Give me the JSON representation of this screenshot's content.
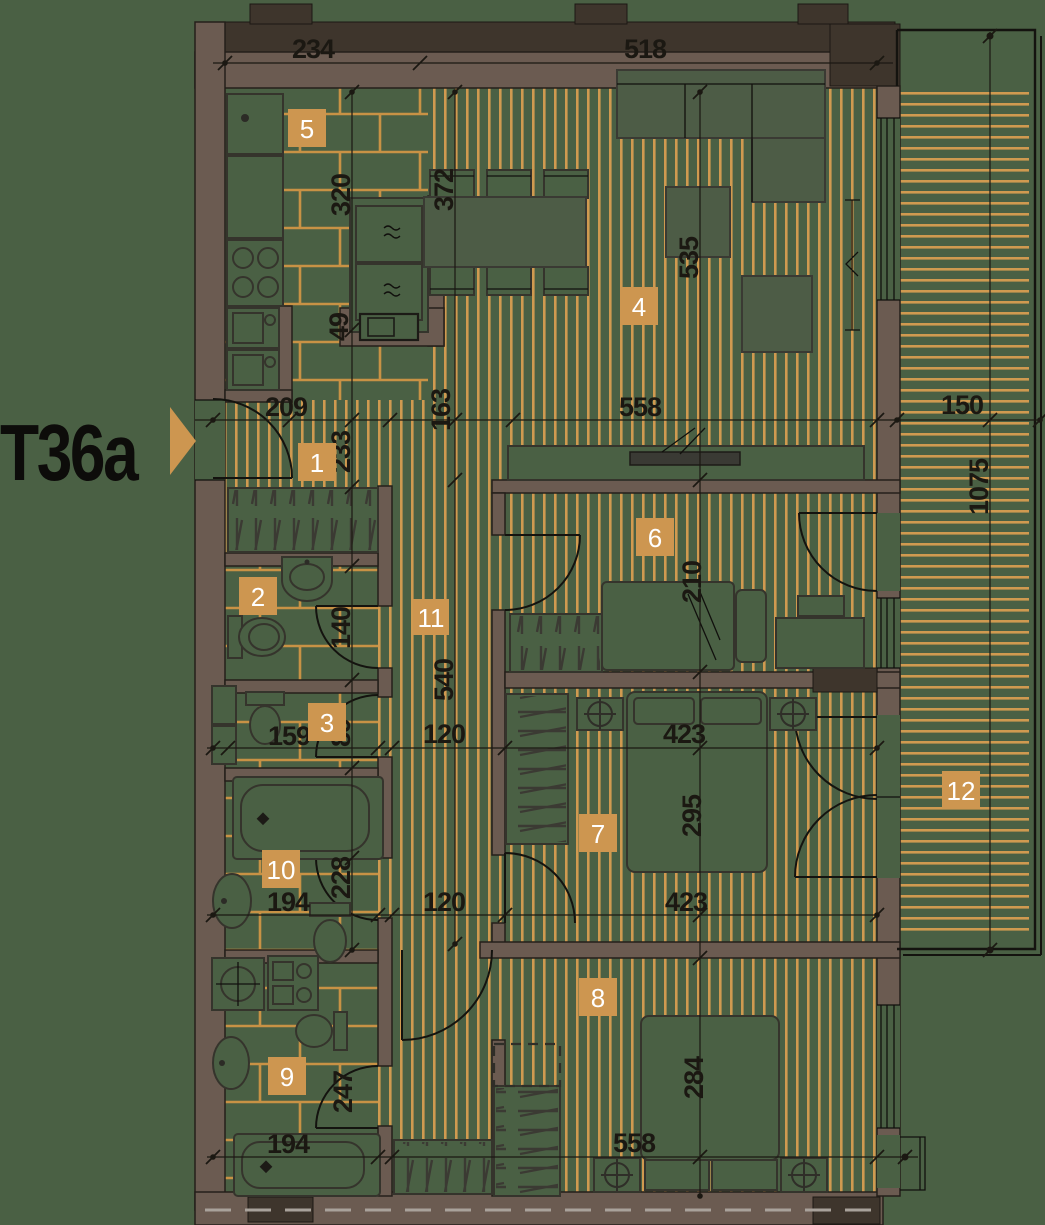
{
  "title": {
    "label": "T36a"
  },
  "rooms": [
    {
      "number": "1"
    },
    {
      "number": "2"
    },
    {
      "number": "3"
    },
    {
      "number": "4"
    },
    {
      "number": "5"
    },
    {
      "number": "6"
    },
    {
      "number": "7"
    },
    {
      "number": "8"
    },
    {
      "number": "9"
    },
    {
      "number": "10"
    },
    {
      "number": "11"
    },
    {
      "number": "12"
    }
  ],
  "dimensions": [
    {
      "value": "234"
    },
    {
      "value": "518"
    },
    {
      "value": "320"
    },
    {
      "value": "372"
    },
    {
      "value": "535"
    },
    {
      "value": "49"
    },
    {
      "value": "209"
    },
    {
      "value": "163"
    },
    {
      "value": "558"
    },
    {
      "value": "150"
    },
    {
      "value": "233"
    },
    {
      "value": "1075"
    },
    {
      "value": "140"
    },
    {
      "value": "540"
    },
    {
      "value": "210"
    },
    {
      "value": "159"
    },
    {
      "value": "89"
    },
    {
      "value": "120"
    },
    {
      "value": "423"
    },
    {
      "value": "295"
    },
    {
      "value": "228"
    },
    {
      "value": "194"
    },
    {
      "value": "120"
    },
    {
      "value": "423"
    },
    {
      "value": "247"
    },
    {
      "value": "284"
    },
    {
      "value": "194"
    },
    {
      "value": "558"
    }
  ],
  "colors": {
    "background": "#4a6044",
    "floor_stripe": "#d09a50",
    "tile_line": "#c89245",
    "badge": "#cd9650",
    "wall": "#6b5b51",
    "wall_dark": "#3e352c",
    "line": "#1b1812",
    "badge_text": "#ffffff"
  }
}
